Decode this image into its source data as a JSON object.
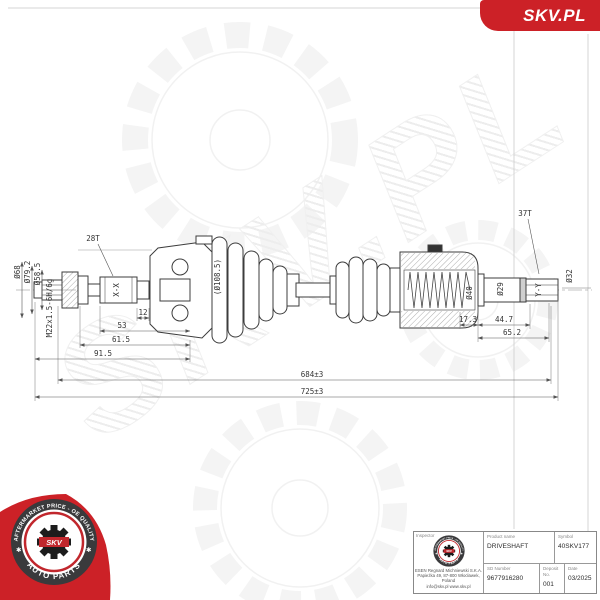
{
  "brand": {
    "badge_text": "SKV.PL",
    "brand_red": "#cc2127",
    "stamp_red": "#c1272d",
    "stamp_dark": "#3a3a3c"
  },
  "watermark": {
    "text": "SKV.PL"
  },
  "stamp": {
    "arc_top": "AFTERMARKET PRICE - OE QUALITY",
    "arc_bottom": "AUTO PARTS",
    "center": "SKV",
    "star": "✱"
  },
  "drawing": {
    "dims": {
      "t28": "28T",
      "t37": "37T",
      "xx": "X-X",
      "yy": "Y-Y",
      "d68": "Ø68",
      "d79": "Ø79.2",
      "d58": "Ø58.5",
      "thread": "M22x1.5-6H/6g",
      "boot": "(Ø108.5)",
      "d40": "Ø40",
      "d29": "Ø29",
      "d32": "Ø32",
      "w12": "12",
      "w53": "53",
      "w615": "61.5",
      "w915": "91.5",
      "w173": "17.3",
      "w447": "44.7",
      "w652": "65.2",
      "len684": "684±3",
      "len725": "725±3"
    }
  },
  "title_block": {
    "inspector_label": "Inspector",
    "product_name_label": "Product name",
    "product_name": "DRIVESHAFT",
    "symbol_label": "Symbol",
    "symbol": "40SKV177",
    "sd_number_label": "SD Number",
    "sd_number": "9677916280",
    "deposit_label": "Deposit No.",
    "deposit": "001",
    "date_label": "Date",
    "date": "03/2025",
    "address_line1": "ESEN Regnard Michniewski S.K.A.",
    "address_line2": "Papieżka 49, 87-800 Włocławek, Poland",
    "address_line3": "info@skv.pl  www.skv.pl"
  }
}
